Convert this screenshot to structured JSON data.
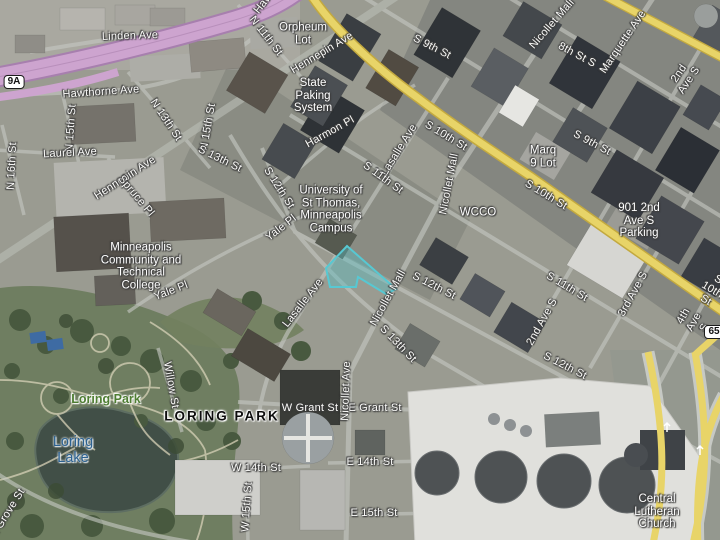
{
  "map": {
    "view": "aerial-with-labels",
    "colors": {
      "road_yellow": "#e8d468",
      "road_yellow_edge": "#c3a93f",
      "hw_purple": "#cda4cf",
      "hw_purple_edge": "#a77fae",
      "parcel_fill": "rgba(88,188,192,0.42)",
      "parcel_stroke": "#57c8d2",
      "park_label": "#4e7d32",
      "water_label": "#2d6291"
    },
    "selected_parcel_points": "347,246 396,289 386,294 358,277 356,287 330,287 326,268",
    "labels": [
      {
        "name": "label-linden-ave",
        "text": "Linden Ave",
        "x": 130,
        "y": 36,
        "rot": -2,
        "cls": "street"
      },
      {
        "name": "label-hawthorne-ave",
        "text": "Hawthorne Ave",
        "x": 101,
        "y": 92,
        "rot": -4,
        "cls": "street"
      },
      {
        "name": "label-hawthorne-ave-2",
        "text": "Hawthorne Ave",
        "x": 280,
        "y": -18,
        "rot": -52,
        "cls": "street"
      },
      {
        "name": "label-n-11th-st",
        "text": "N 11th St",
        "x": 266,
        "y": 36,
        "rot": 52,
        "cls": "street"
      },
      {
        "name": "label-orpheum-lot",
        "text": "Orpheum\nLot",
        "x": 303,
        "y": 34,
        "rot": 0,
        "cls": "place"
      },
      {
        "name": "label-hennepin-ave-1",
        "text": "Hennepin Ave",
        "x": 322,
        "y": 53,
        "rot": -31,
        "cls": "street"
      },
      {
        "name": "label-s-9th-st-1",
        "text": "S 9th St",
        "x": 432,
        "y": 47,
        "rot": 27,
        "cls": "street"
      },
      {
        "name": "label-state-parking-system",
        "text": "State\nPaking\nSystem",
        "x": 313,
        "y": 96,
        "rot": 0,
        "cls": "place"
      },
      {
        "name": "label-nicollet-mall-1",
        "text": "Nicollet Mall",
        "x": 552,
        "y": 24,
        "rot": -49,
        "cls": "street"
      },
      {
        "name": "label-8th-st-s",
        "text": "8th St S",
        "x": 577,
        "y": 55,
        "rot": 28,
        "cls": "street"
      },
      {
        "name": "label-marquette-ave",
        "text": "Marquette Ave",
        "x": 623,
        "y": 42,
        "rot": -56,
        "cls": "street"
      },
      {
        "name": "label-2nd-ave-s-1",
        "text": "2nd Ave S",
        "x": 684,
        "y": 77,
        "rot": -56,
        "cls": "street"
      },
      {
        "name": "label-s-10th-st-1",
        "text": "S 10th St",
        "x": 446,
        "y": 136,
        "rot": 31,
        "cls": "street"
      },
      {
        "name": "label-harmon-pl",
        "text": "Harmon Pl",
        "x": 330,
        "y": 132,
        "rot": -29,
        "cls": "street"
      },
      {
        "name": "label-lasalle-ave-1",
        "text": "Lasalle Ave",
        "x": 399,
        "y": 150,
        "rot": -58,
        "cls": "street"
      },
      {
        "name": "label-nicollet-mall-2",
        "text": "Nicollet Mall",
        "x": 449,
        "y": 184,
        "rot": -79,
        "cls": "street"
      },
      {
        "name": "label-s-9th-st-2",
        "text": "S 9th St",
        "x": 592,
        "y": 143,
        "rot": 28,
        "cls": "street"
      },
      {
        "name": "label-marq-9-lot",
        "text": "Marq\n9 Lot",
        "x": 543,
        "y": 157,
        "rot": 0,
        "cls": "place"
      },
      {
        "name": "label-s-10th-st-2",
        "text": "S 10th St",
        "x": 546,
        "y": 195,
        "rot": 31,
        "cls": "street"
      },
      {
        "name": "label-wcco",
        "text": "WCCO",
        "x": 478,
        "y": 213,
        "rot": 0,
        "cls": "place"
      },
      {
        "name": "label-s-11th-st-1",
        "text": "S 11th St",
        "x": 383,
        "y": 178,
        "rot": 36,
        "cls": "street"
      },
      {
        "name": "label-s-10th-st-3",
        "text": "S 10th St",
        "x": 712,
        "y": 290,
        "rot": 31,
        "cls": "street"
      },
      {
        "name": "label-901-2nd-ave-s-parking",
        "text": "901 2nd\nAve S\nParking",
        "x": 639,
        "y": 221,
        "rot": 0,
        "cls": "place"
      },
      {
        "name": "label-hennepin-ave-2",
        "text": "Hennepin Ave",
        "x": 125,
        "y": 178,
        "rot": -33,
        "cls": "street"
      },
      {
        "name": "label-n-15th-st-1",
        "text": "N 15th St",
        "x": 71,
        "y": 128,
        "rot": -86,
        "cls": "street"
      },
      {
        "name": "label-n-13th-st",
        "text": "N 13th St",
        "x": 166,
        "y": 120,
        "rot": 56,
        "cls": "street"
      },
      {
        "name": "label-n-15th-st-2",
        "text": "N 15th St",
        "x": 208,
        "y": 127,
        "rot": -80,
        "cls": "street"
      },
      {
        "name": "label-n-16th-st",
        "text": "N 16th St",
        "x": 12,
        "y": 166,
        "rot": -87,
        "cls": "street"
      },
      {
        "name": "label-laurel-ave",
        "text": "Laurel Ave",
        "x": 70,
        "y": 153,
        "rot": -3,
        "cls": "street"
      },
      {
        "name": "label-s-13th-st-1",
        "text": "S 13th St",
        "x": 220,
        "y": 159,
        "rot": 26,
        "cls": "street"
      },
      {
        "name": "label-spruce-pl",
        "text": "Spruce Pl",
        "x": 136,
        "y": 196,
        "rot": 50,
        "cls": "street"
      },
      {
        "name": "label-s-12th-st-1",
        "text": "S 12th St",
        "x": 279,
        "y": 188,
        "rot": 57,
        "cls": "street"
      },
      {
        "name": "label-yale-pl-1",
        "text": "Yale Pl",
        "x": 281,
        "y": 228,
        "rot": -38,
        "cls": "street"
      },
      {
        "name": "label-yale-pl-2",
        "text": "Yale Pl",
        "x": 171,
        "y": 291,
        "rot": -21,
        "cls": "street"
      },
      {
        "name": "label-mctc",
        "text": "Minneapolis\nCommunity and\nTechnical\nCollege",
        "x": 141,
        "y": 267,
        "rot": 0,
        "cls": "place"
      },
      {
        "name": "label-university-st-thomas",
        "text": "University of\nSt Thomas,\nMinneapolis\nCampus",
        "x": 331,
        "y": 210,
        "rot": 0,
        "cls": "place"
      },
      {
        "name": "label-lasalle-ave-2",
        "text": "Lasalle Ave",
        "x": 303,
        "y": 303,
        "rot": -52,
        "cls": "street"
      },
      {
        "name": "label-nicollet-mall-3",
        "text": "Nicollet Mall",
        "x": 388,
        "y": 298,
        "rot": -61,
        "cls": "street"
      },
      {
        "name": "label-s-12th-st-2",
        "text": "S 12th St",
        "x": 434,
        "y": 286,
        "rot": 27,
        "cls": "street"
      },
      {
        "name": "label-s-13th-st-2",
        "text": "S 13th St",
        "x": 398,
        "y": 344,
        "rot": 46,
        "cls": "street"
      },
      {
        "name": "label-2nd-ave-s-2",
        "text": "2nd Ave S",
        "x": 542,
        "y": 322,
        "rot": -61,
        "cls": "street"
      },
      {
        "name": "label-3rd-ave-s",
        "text": "3rd Ave S",
        "x": 633,
        "y": 294,
        "rot": -61,
        "cls": "street"
      },
      {
        "name": "label-4th-ave-s",
        "text": "4th Ave S",
        "x": 694,
        "y": 322,
        "rot": -61,
        "cls": "street"
      },
      {
        "name": "label-s-11th-st-2",
        "text": "S 11th St",
        "x": 567,
        "y": 287,
        "rot": 31,
        "cls": "street"
      },
      {
        "name": "label-s-12th-st-3",
        "text": "S 12th St",
        "x": 565,
        "y": 366,
        "rot": 27,
        "cls": "street"
      },
      {
        "name": "label-willow-st",
        "text": "Willow St",
        "x": 171,
        "y": 385,
        "rot": 80,
        "cls": "street"
      },
      {
        "name": "label-loring-park",
        "text": "Loring Park",
        "x": 106,
        "y": 400,
        "rot": 0,
        "cls": "park"
      },
      {
        "name": "label-loring-park-district",
        "text": "LORING PARK",
        "x": 222,
        "y": 417,
        "rot": 0,
        "cls": "district"
      },
      {
        "name": "label-loring-lake",
        "text": "Loring\nLake",
        "x": 73,
        "y": 451,
        "rot": 0,
        "cls": "water"
      },
      {
        "name": "label-w-grant-st",
        "text": "W Grant St",
        "x": 310,
        "y": 408,
        "rot": 0,
        "cls": "street"
      },
      {
        "name": "label-e-grant-st",
        "text": "E Grant St",
        "x": 375,
        "y": 408,
        "rot": 0,
        "cls": "street"
      },
      {
        "name": "label-nicollet-ave",
        "text": "Nicollet Ave",
        "x": 346,
        "y": 391,
        "rot": -88,
        "cls": "street"
      },
      {
        "name": "label-w-14th-st",
        "text": "W 14th St",
        "x": 256,
        "y": 468,
        "rot": 0,
        "cls": "street"
      },
      {
        "name": "label-w-15th-st",
        "text": "W 15th St",
        "x": 247,
        "y": 507,
        "rot": -86,
        "cls": "street"
      },
      {
        "name": "label-e-14th-st",
        "text": "E 14th St",
        "x": 370,
        "y": 462,
        "rot": 0,
        "cls": "street"
      },
      {
        "name": "label-e-15th-st",
        "text": "E 15th St",
        "x": 374,
        "y": 513,
        "rot": 0,
        "cls": "street"
      },
      {
        "name": "label-central-lutheran-church",
        "text": "Central\nLutheran\nChurch",
        "x": 657,
        "y": 512,
        "rot": 0,
        "cls": "place"
      },
      {
        "name": "label-oak-grove-st",
        "text": "Oak Grove St",
        "x": 4,
        "y": 519,
        "rot": -58,
        "cls": "street"
      },
      {
        "name": "shield-9a",
        "text": "9A",
        "x": 14,
        "y": 82,
        "rot": 0,
        "cls": "shield"
      },
      {
        "name": "shield-65",
        "text": "65",
        "x": 714,
        "y": 332,
        "rot": 0,
        "cls": "shield"
      }
    ]
  }
}
